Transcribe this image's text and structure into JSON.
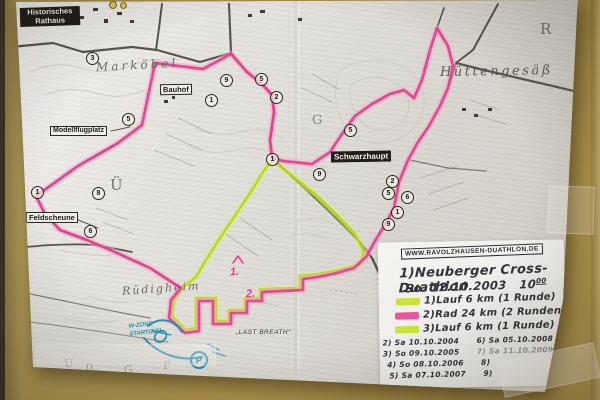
{
  "map": {
    "boxed_labels": {
      "historisches_rathaus": "Historisches Rathaus",
      "bauhof": "Bauhof",
      "modellflugplatz": "Modellflugplatz",
      "feldscheune": "Feldscheune",
      "schwarzhaupt": "Schwarzhaupt"
    },
    "place_names": {
      "markoebel": "Marköbel",
      "huettengesaess": "Hüttengesäß",
      "ruedigheim": "Rüdigheim"
    },
    "grid_letters": [
      "R",
      "Ü",
      "G",
      "U",
      "0.",
      "G",
      "F"
    ],
    "checkpoints": [
      "3",
      "5",
      "9",
      "1",
      "5",
      "2",
      "1",
      "9",
      "5",
      "1",
      "8",
      "6",
      "2",
      "5",
      "6",
      "1",
      "9"
    ]
  },
  "course_markers": {
    "point1": "1.",
    "point2": "2.",
    "last_breath": "„LAST BREATH“",
    "w_zone_line1": "W-ZONE",
    "w_zone_line2": "START/ZIEL",
    "parking": "P"
  },
  "handwriting": {
    "url": "WWW.RAVOLZHAUSEN-DUATHLON.DE",
    "title": "1)Neuberger Cross-Duathlon",
    "date": "So. 12.10.2003",
    "time": "10",
    "time_sup": "00",
    "legend": [
      {
        "color": "#cbe23c",
        "label": "1)Lauf 6 km (1 Runde)"
      },
      {
        "color": "#e8559c",
        "label": "2)Rad 24 km (2 Runden)"
      },
      {
        "color": "#cbe23c",
        "label": "3)Lauf 6 km (1 Runde)"
      }
    ],
    "events": [
      [
        "2) Sa 10.10.2004",
        "6) Sa 05.10.2008"
      ],
      [
        "3) So 09.10.2005",
        "7) Sa 11.10.2009"
      ],
      [
        "4) So 08.10.2006",
        "8)"
      ],
      [
        "5) Sa 07.10.2007",
        "9)"
      ]
    ]
  },
  "colors": {
    "bike_route": "#e2458d",
    "run_route": "#b5d622",
    "pen_blue": "#2591b5",
    "wall": "#b0954f",
    "paper": "#e7e5e1"
  }
}
